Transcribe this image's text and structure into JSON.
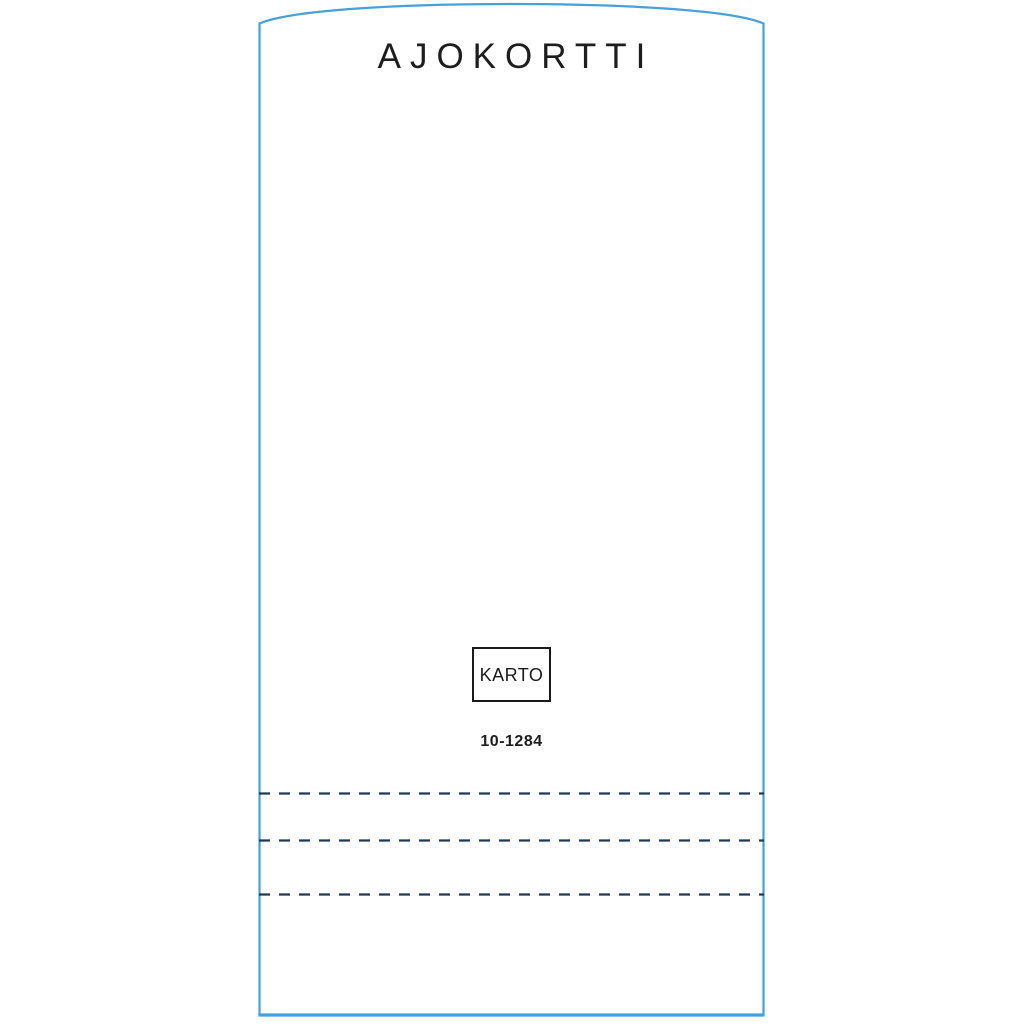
{
  "template": {
    "title": "AJOKORTTI",
    "brand_label": "KARTO",
    "product_code": "10-1284"
  },
  "colors": {
    "outline_blue": "#46a0da",
    "perforation_navy": "#1d3a56",
    "ink_black": "#1d1d1d"
  }
}
